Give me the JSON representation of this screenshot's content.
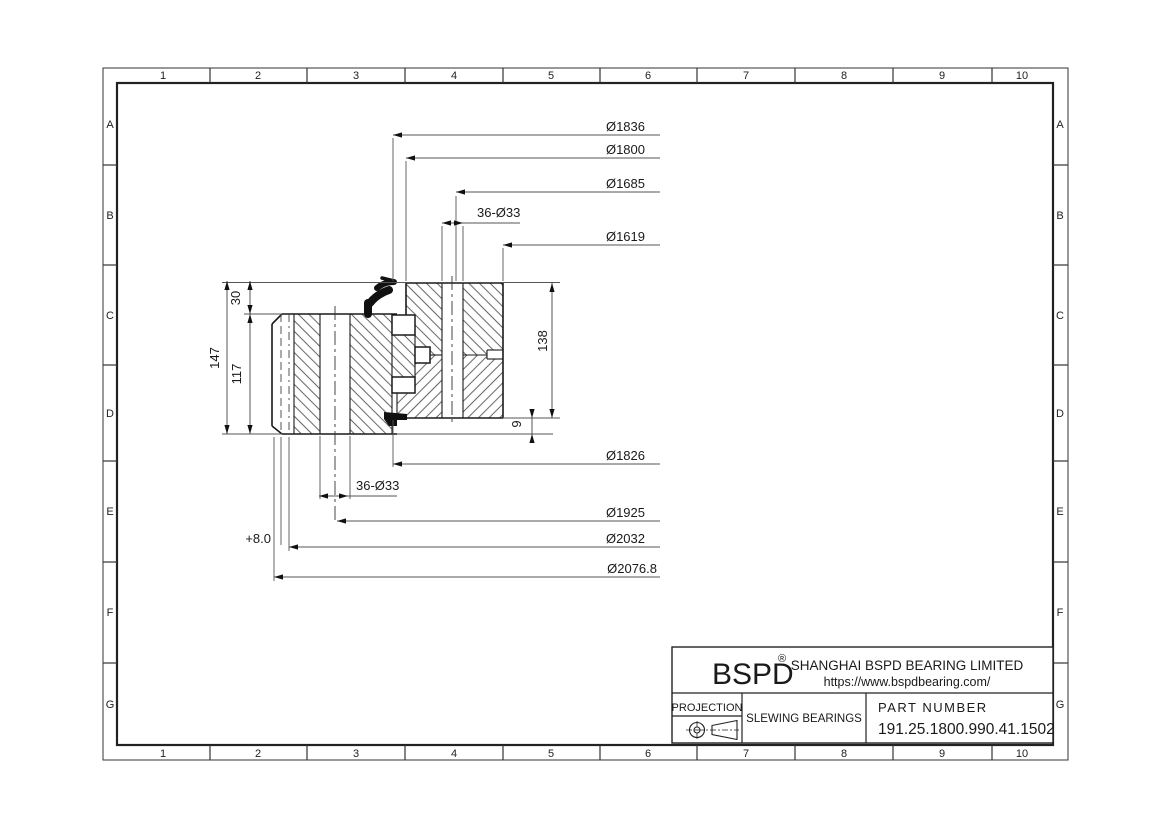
{
  "sheet": {
    "columns": [
      "1",
      "2",
      "3",
      "4",
      "5",
      "6",
      "7",
      "8",
      "9",
      "10"
    ],
    "rows": [
      "A",
      "B",
      "C",
      "D",
      "E",
      "F",
      "G"
    ]
  },
  "dimensions": {
    "d1836": "Ø1836",
    "d1800": "Ø1800",
    "d1685": "Ø1685",
    "bolt_top": "36-Ø33",
    "d1619": "Ø1619",
    "d1826": "Ø1826",
    "bolt_bottom": "36-Ø33",
    "d1925": "Ø1925",
    "d2032": "Ø2032",
    "gear_shift": "+8.0",
    "d2076": "Ø2076.8",
    "h147": "147",
    "h30": "30",
    "h117": "117",
    "h138": "138",
    "h9": "9"
  },
  "title_block": {
    "logo": "BSPD",
    "registered_mark": "®",
    "company": "SHANGHAI BSPD BEARING LIMITED",
    "website": "https://www.bspdbearing.com/",
    "projection_label": "PROJECTION",
    "product_type": "SLEWING BEARINGS",
    "part_number_label": "PART NUMBER",
    "part_number": "191.25.1800.990.41.1502"
  }
}
